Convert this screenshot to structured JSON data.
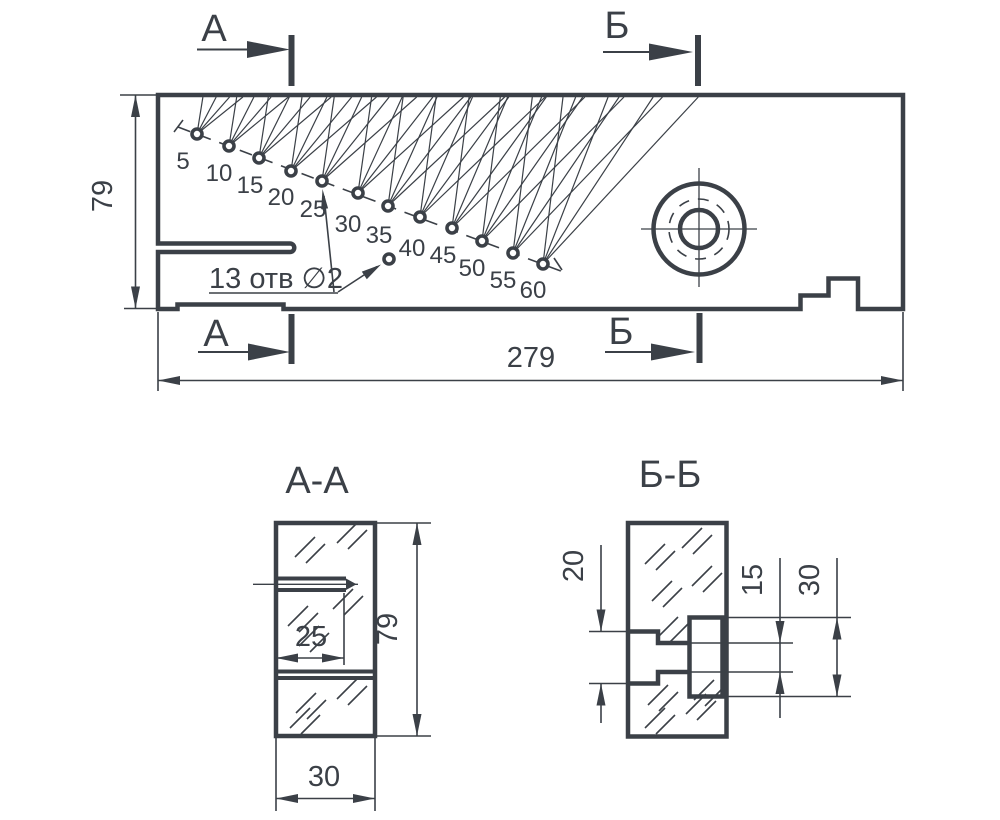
{
  "main_view": {
    "marker_top_left": "А",
    "marker_top_right": "Б",
    "marker_bottom_left": "А",
    "marker_bottom_right": "Б",
    "dim_height": "79",
    "dim_length": "279",
    "holes_note": "13 отв ∅2",
    "hole_labels": [
      "5",
      "10",
      "15",
      "20",
      "25",
      "30",
      "35",
      "40",
      "45",
      "50",
      "55",
      "60"
    ]
  },
  "section_aa": {
    "title": "А-А",
    "dim_hole_depth": "25",
    "dim_height": "79",
    "dim_width": "30"
  },
  "section_bb": {
    "title": "Б-Б",
    "dim_counterbore_left": "20",
    "dim_hole": "15",
    "dim_counterbore_right": "30"
  },
  "colors": {
    "line": "#3b4047",
    "background": "#ffffff"
  }
}
